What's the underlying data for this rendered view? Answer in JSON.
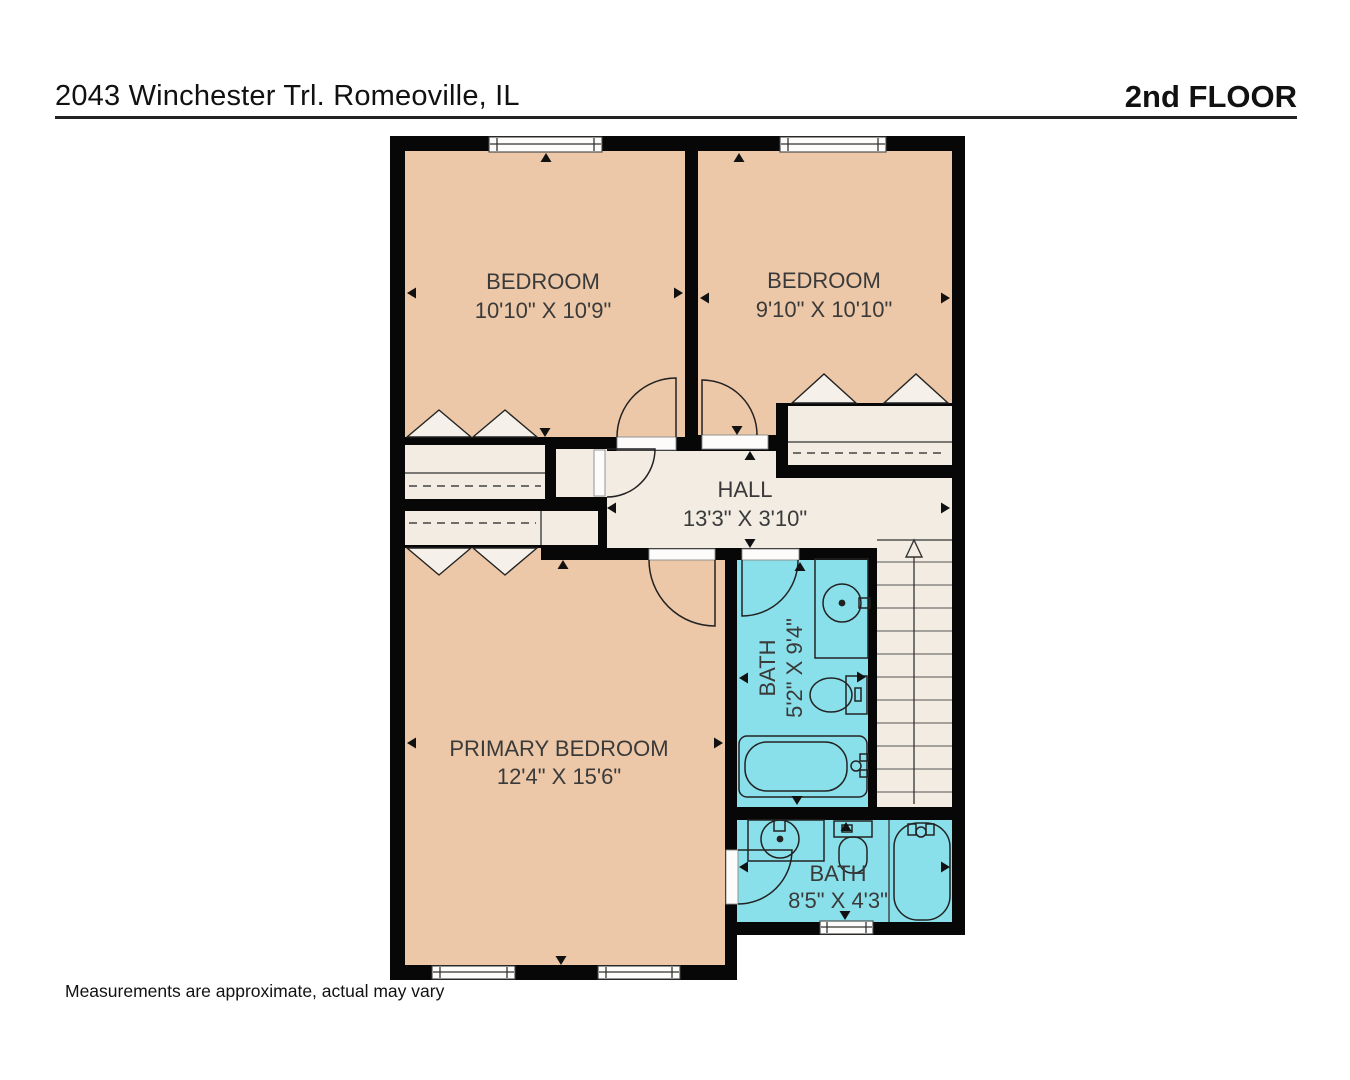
{
  "header": {
    "address": "2043 Winchester Trl. Romeoville, IL",
    "floor_label": "2nd FLOOR"
  },
  "footer": {
    "disclaimer": "Measurements are approximate, actual may vary"
  },
  "colors": {
    "wall": "#070707",
    "bedroom_fill": "#ecc8a8",
    "hall_fill": "#f2ece3",
    "bath_fill": "#8ae0ea",
    "closet_fill": "#f2ece3",
    "stairs_fill": "#f2ece3"
  },
  "rooms": {
    "bedroom1": {
      "name": "BEDROOM",
      "dimensions": "10'10\" X 10'9\""
    },
    "bedroom2": {
      "name": "BEDROOM",
      "dimensions": "9'10\" X 10'10\""
    },
    "hall": {
      "name": "HALL",
      "dimensions": "13'3\" X 3'10\""
    },
    "primary_bedroom": {
      "name": "PRIMARY BEDROOM",
      "dimensions": "12'4\" X 15'6\""
    },
    "bath1": {
      "name": "BATH",
      "dimensions": "5'2\" X 9'4\""
    },
    "bath2": {
      "name": "BATH",
      "dimensions": "8'5\" X 4'3\""
    }
  },
  "icons": {
    "stairs_up_arrow": "direction-up",
    "sink": "round basin with faucet",
    "toilet": "tank and bowl",
    "bathtub": "rounded tub with faucet"
  }
}
